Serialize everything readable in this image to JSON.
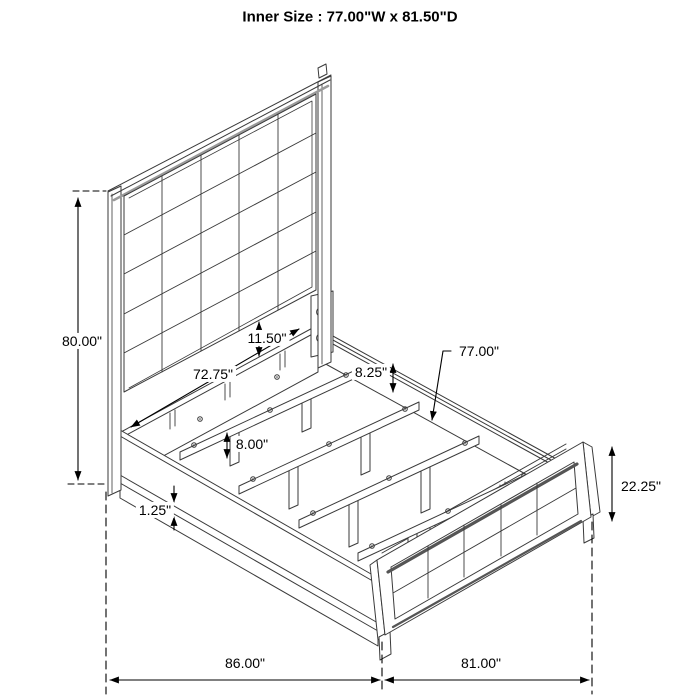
{
  "title": "Inner Size : 77.00\"W x 81.50\"D",
  "drawing": {
    "subject": "bed-frame-isometric-dimension-diagram",
    "line_color": "#3a3a3a",
    "dimension_color": "#000000",
    "background": "#ffffff"
  },
  "dimensions": {
    "headboard_height": "80.00\"",
    "panel_to_rail_gap": "11.50\"",
    "headboard_inner_width": "72.75\"",
    "rail_to_slat": "8.25\"",
    "slat_length": "77.00\"",
    "slat_spacing": "8.00\"",
    "rail_trim_thickness": "1.25\"",
    "footboard_height": "22.25\"",
    "overall_depth": "86.00\"",
    "overall_width": "81.00\""
  }
}
